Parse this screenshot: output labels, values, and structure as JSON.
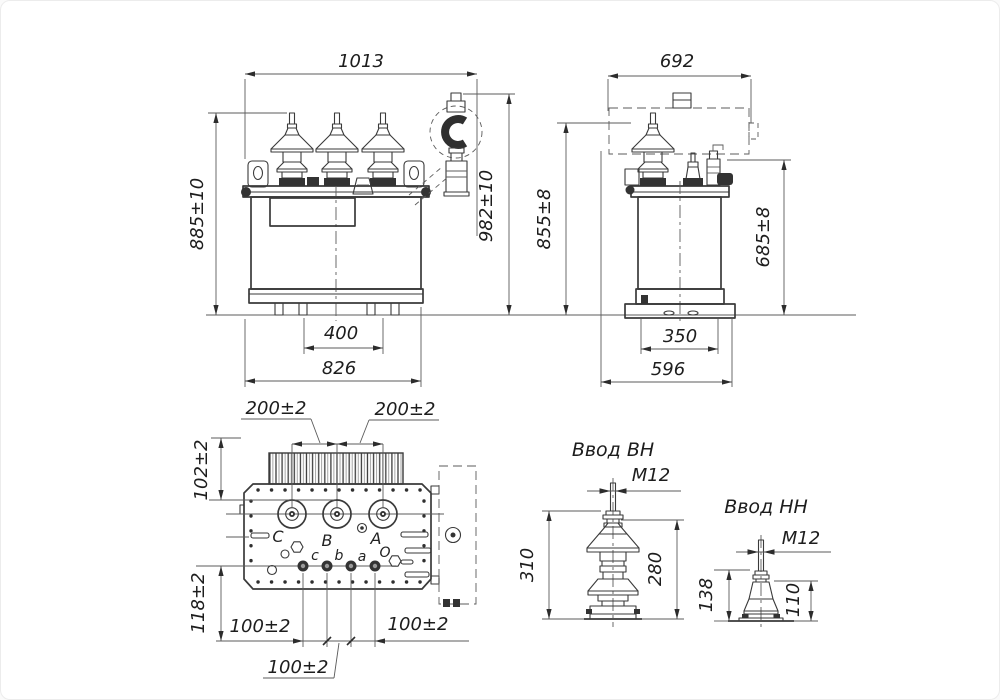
{
  "colors": {
    "line": "#3a3a3a",
    "thin": "#5b5b5b",
    "text": "#1d1d1d",
    "background": "#ffffff"
  },
  "front_view": {
    "overall_width": "1013",
    "overall_height": "885±10",
    "height_with_breather": "982±10",
    "skid_spacing": "400",
    "base_width": "826"
  },
  "side_view": {
    "overall_width": "692",
    "overall_height": "855±8",
    "tank_height": "685±8",
    "base_inner": "350",
    "base_width": "596"
  },
  "top_view": {
    "hv_spacing_left": "200±2",
    "hv_spacing_right": "200±2",
    "fin_depth": "102±2",
    "lv_row_offset": "118±2",
    "lv_spacing_left": "100±2",
    "lv_spacing_mid": "100±2",
    "lv_spacing_right": "100±2",
    "hv_terminals": [
      "С",
      "В",
      "А"
    ],
    "lv_terminals": [
      "с",
      "b",
      "а",
      "О"
    ]
  },
  "hv_bushing": {
    "title": "Ввод ВН",
    "thread": "М12",
    "total_height": "310",
    "insulator_height": "280"
  },
  "lv_bushing": {
    "title": "Ввод НН",
    "thread": "М12",
    "total_height": "138",
    "insulator_height": "110"
  }
}
